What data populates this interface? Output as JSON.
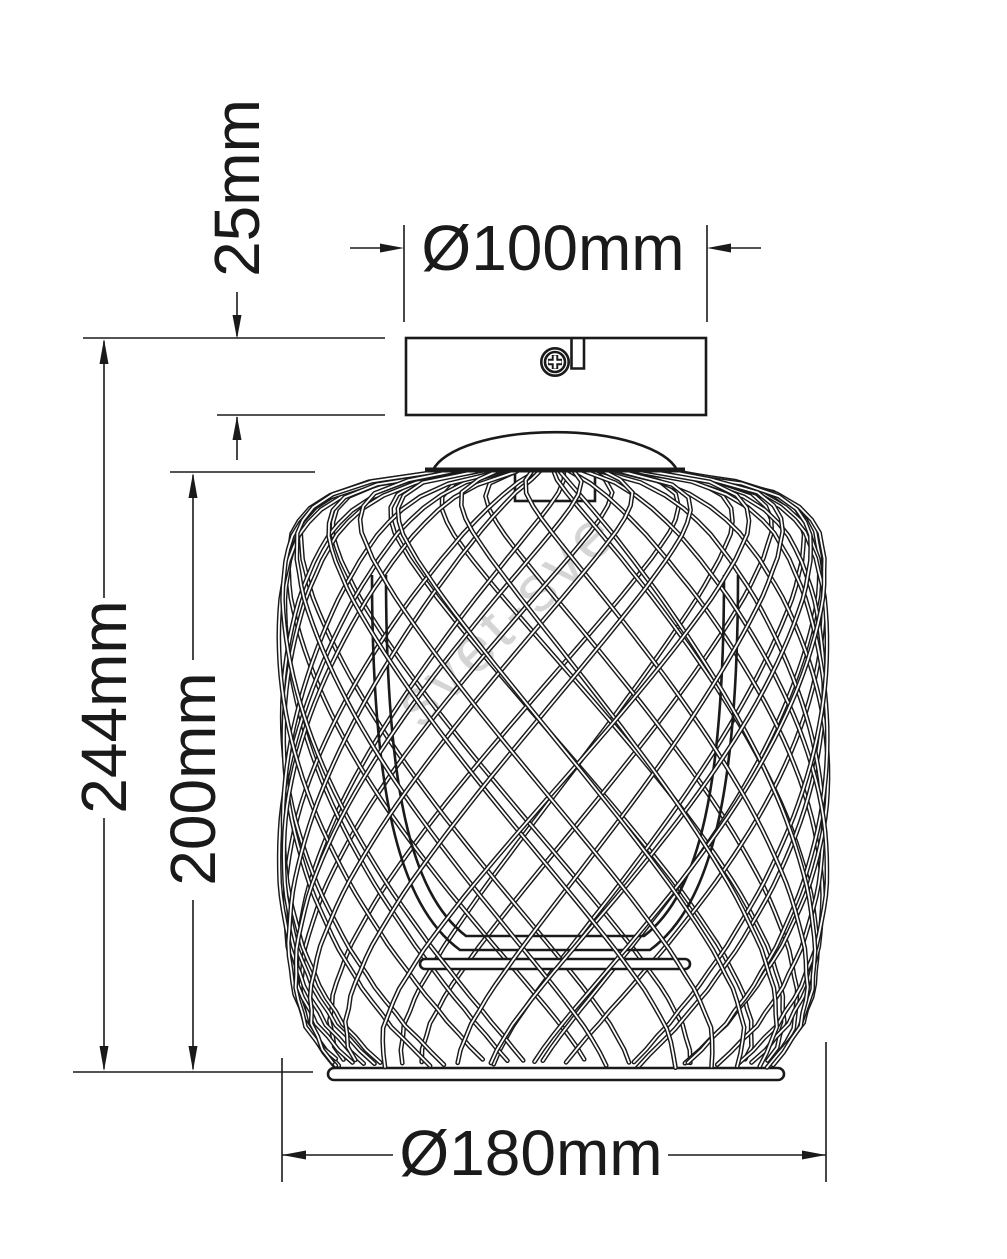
{
  "drawing": {
    "type": "technical-dimension-drawing",
    "subject": "wire-cage-ceiling-lamp",
    "labels": {
      "canopy_height": "25mm",
      "canopy_diameter": "Ø100mm",
      "overall_height": "244mm",
      "shade_height": "200mm",
      "shade_diameter": "Ø180mm"
    },
    "watermark": "svet-sve",
    "colors": {
      "ink": "#1a1a1a",
      "watermark": "#b3b3b3",
      "background": "#ffffff"
    }
  }
}
